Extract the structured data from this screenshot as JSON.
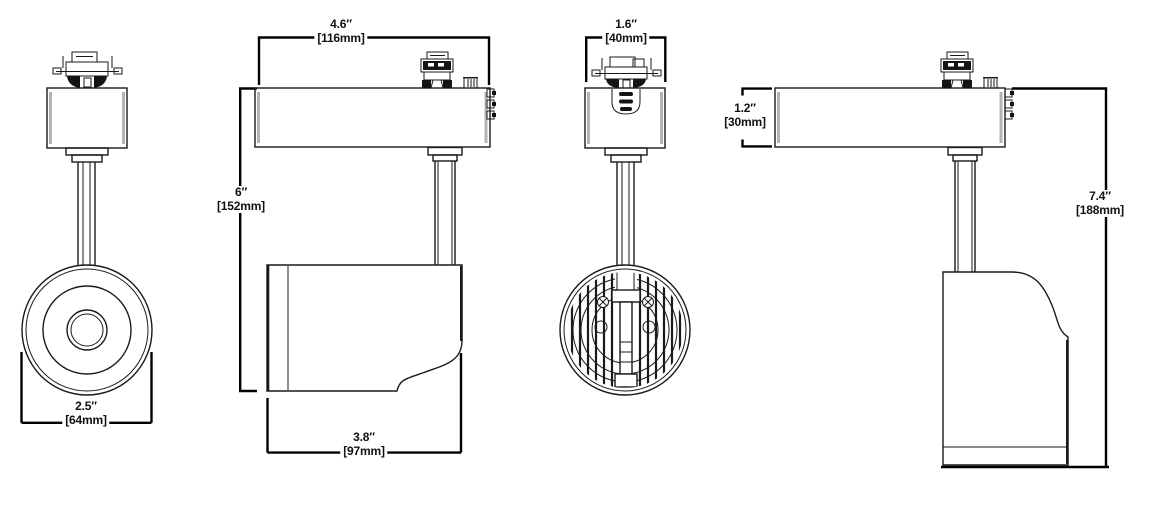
{
  "page": {
    "background": "#ffffff",
    "ink": "#1a1a1a"
  },
  "dimensions": {
    "lens_diameter": {
      "inches": "2.5″",
      "metric": "[64mm]"
    },
    "body_length": {
      "inches": "4.6″",
      "metric": "[116mm]"
    },
    "mount_to_head_height": {
      "inches": "6″",
      "metric": "[152mm]"
    },
    "head_length": {
      "inches": "3.8″",
      "metric": "[97mm]"
    },
    "body_width": {
      "inches": "1.6″",
      "metric": "[40mm]"
    },
    "body_height": {
      "inches": "1.2″",
      "metric": "[30mm]"
    },
    "overall_height": {
      "inches": "7.4″",
      "metric": "[188mm]"
    }
  }
}
